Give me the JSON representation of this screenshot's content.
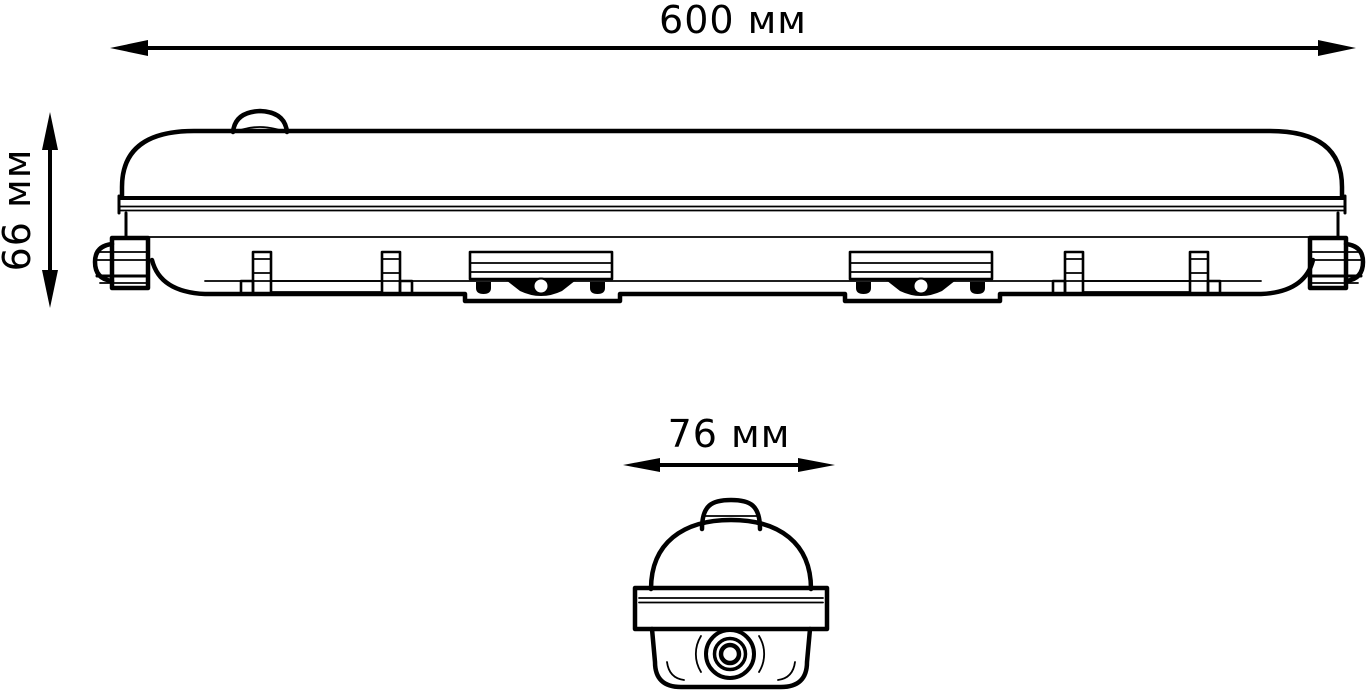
{
  "page": {
    "background": "#ffffff",
    "line_color": "#000000"
  },
  "dimensions": {
    "length": {
      "label": "600 мм",
      "value": 600,
      "unit": "мм"
    },
    "height": {
      "label": "66 мм",
      "value": 66,
      "unit": "мм"
    },
    "width": {
      "label": "76 мм",
      "value": 76,
      "unit": "мм"
    }
  }
}
